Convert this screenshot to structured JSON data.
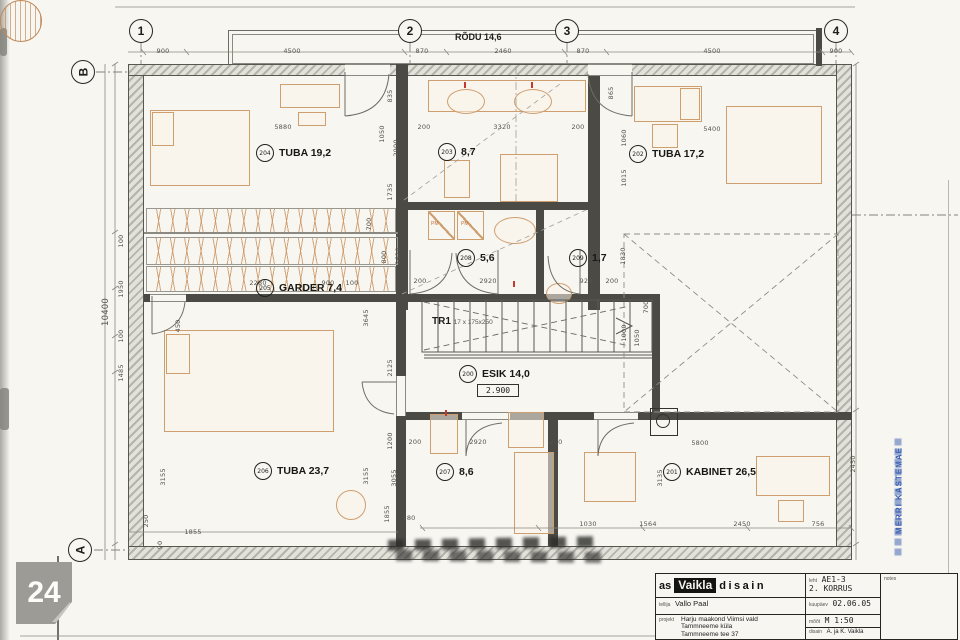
{
  "drawing": {
    "floor_title": "2. KORRUS",
    "balcony_label": "RÕDU 14,6",
    "stair": {
      "label": "TR1",
      "spec": "17 x 175x250"
    },
    "esik_level": "2.900",
    "appliance_label": "PM"
  },
  "axes": {
    "top": [
      {
        "label": "1",
        "x": 141
      },
      {
        "label": "2",
        "x": 410
      },
      {
        "label": "3",
        "x": 567
      },
      {
        "label": "4",
        "x": 836
      }
    ],
    "left": [
      {
        "label": "B",
        "x": 83,
        "y": 72
      },
      {
        "label": "A",
        "x": 80,
        "y": 550
      }
    ]
  },
  "rooms": [
    {
      "num": "204",
      "name": "TUBA 19,2",
      "x": 256,
      "y": 144
    },
    {
      "num": "203",
      "name": "8,7",
      "x": 438,
      "y": 143
    },
    {
      "num": "202",
      "name": "TUBA 17,2",
      "x": 629,
      "y": 145
    },
    {
      "num": "205",
      "name": "GARDER 7,4",
      "x": 256,
      "y": 279
    },
    {
      "num": "208",
      "name": "5,6",
      "x": 457,
      "y": 249
    },
    {
      "num": "209",
      "name": "1,7",
      "x": 569,
      "y": 249
    },
    {
      "num": "200",
      "name": "ESIK 14,0",
      "x": 459,
      "y": 365
    },
    {
      "num": "206",
      "name": "TUBA 23,7",
      "x": 254,
      "y": 462
    },
    {
      "num": "207",
      "name": "8,6",
      "x": 436,
      "y": 463
    },
    {
      "num": "201",
      "name": "KABINET 26,5",
      "x": 663,
      "y": 463
    }
  ],
  "dims": [
    {
      "t": "900",
      "x": 163,
      "y": 51
    },
    {
      "t": "4500",
      "x": 292,
      "y": 51
    },
    {
      "t": "870",
      "x": 422,
      "y": 51
    },
    {
      "t": "2460",
      "x": 503,
      "y": 51
    },
    {
      "t": "870",
      "x": 583,
      "y": 51
    },
    {
      "t": "4500",
      "x": 712,
      "y": 51
    },
    {
      "t": "900",
      "x": 836,
      "y": 51
    },
    {
      "t": "5880",
      "x": 283,
      "y": 127
    },
    {
      "t": "200",
      "x": 424,
      "y": 127
    },
    {
      "t": "3320",
      "x": 502,
      "y": 127
    },
    {
      "t": "200",
      "x": 578,
      "y": 127
    },
    {
      "t": "5400",
      "x": 712,
      "y": 129
    },
    {
      "t": "835",
      "x": 390,
      "y": 96,
      "v": 1
    },
    {
      "t": "865",
      "x": 611,
      "y": 93,
      "v": 1
    },
    {
      "t": "1050",
      "x": 382,
      "y": 134,
      "v": 1
    },
    {
      "t": "2900",
      "x": 396,
      "y": 148,
      "v": 1
    },
    {
      "t": "1060",
      "x": 624,
      "y": 138,
      "v": 1
    },
    {
      "t": "1015",
      "x": 624,
      "y": 178,
      "v": 1
    },
    {
      "t": "10400",
      "x": 106,
      "y": 312,
      "v": 1,
      "b": 1
    },
    {
      "t": "100",
      "x": 121,
      "y": 241,
      "v": 1
    },
    {
      "t": "1950",
      "x": 121,
      "y": 289,
      "v": 1
    },
    {
      "t": "100",
      "x": 121,
      "y": 336,
      "v": 1
    },
    {
      "t": "1485",
      "x": 121,
      "y": 373,
      "v": 1
    },
    {
      "t": "450",
      "x": 178,
      "y": 326,
      "v": 1
    },
    {
      "t": "1735",
      "x": 390,
      "y": 192,
      "v": 1
    },
    {
      "t": "1620",
      "x": 398,
      "y": 256,
      "v": 1
    },
    {
      "t": "3645",
      "x": 366,
      "y": 318,
      "v": 1
    },
    {
      "t": "2125",
      "x": 390,
      "y": 368,
      "v": 1
    },
    {
      "t": "1200",
      "x": 390,
      "y": 441,
      "v": 1
    },
    {
      "t": "3155",
      "x": 366,
      "y": 476,
      "v": 1
    },
    {
      "t": "3055",
      "x": 394,
      "y": 478,
      "v": 1
    },
    {
      "t": "1855",
      "x": 387,
      "y": 514,
      "v": 1
    },
    {
      "t": "180",
      "x": 409,
      "y": 518
    },
    {
      "t": "2280",
      "x": 258,
      "y": 283
    },
    {
      "t": "900",
      "x": 328,
      "y": 283
    },
    {
      "t": "100",
      "x": 352,
      "y": 283
    },
    {
      "t": "700",
      "x": 369,
      "y": 224,
      "v": 1
    },
    {
      "t": "800",
      "x": 384,
      "y": 257,
      "v": 1
    },
    {
      "t": "1830",
      "x": 623,
      "y": 256,
      "v": 1
    },
    {
      "t": "200",
      "x": 420,
      "y": 281
    },
    {
      "t": "2920",
      "x": 488,
      "y": 281
    },
    {
      "t": "920",
      "x": 586,
      "y": 281
    },
    {
      "t": "200",
      "x": 612,
      "y": 281
    },
    {
      "t": "700",
      "x": 646,
      "y": 307,
      "v": 1
    },
    {
      "t": "1000",
      "x": 624,
      "y": 333,
      "v": 1
    },
    {
      "t": "1050",
      "x": 637,
      "y": 338,
      "v": 1
    },
    {
      "t": "200",
      "x": 415,
      "y": 442
    },
    {
      "t": "2920",
      "x": 478,
      "y": 442
    },
    {
      "t": "200",
      "x": 556,
      "y": 442
    },
    {
      "t": "5800",
      "x": 700,
      "y": 443
    },
    {
      "t": "1030",
      "x": 588,
      "y": 524
    },
    {
      "t": "1564",
      "x": 648,
      "y": 524
    },
    {
      "t": "2450",
      "x": 742,
      "y": 524
    },
    {
      "t": "756",
      "x": 818,
      "y": 524
    },
    {
      "t": "2450",
      "x": 853,
      "y": 464,
      "v": 1
    },
    {
      "t": "3135",
      "x": 660,
      "y": 478,
      "v": 1
    },
    {
      "t": "250",
      "x": 146,
      "y": 521,
      "v": 1
    },
    {
      "t": "90",
      "x": 160,
      "y": 545,
      "v": 1
    },
    {
      "t": "1855",
      "x": 193,
      "y": 532
    },
    {
      "t": "3155",
      "x": 163,
      "y": 477,
      "v": 1
    }
  ],
  "stamp": {
    "text": "MERRI KASTEMAE"
  },
  "badge": {
    "number": "24"
  },
  "title_block": {
    "brand_prefix": "as",
    "brand_name": "Vaikla",
    "brand_suffix": "disain",
    "sheet_label": "leht",
    "sheet_value": "AE1-3",
    "sheet_value2": "2. KORRUS",
    "notes_label": "notes",
    "client_label": "tellija",
    "client_value": "Vallo Paal",
    "date_label": "kuupäev",
    "date_value": "02.06.05",
    "project_label": "projekt",
    "project_lines": [
      "Harju maakond Viimsi vald",
      "Tammneeme küla",
      "Tammneeme tee 37"
    ],
    "scale_label": "mõõt",
    "scale_value": "M 1:50",
    "design_label": "disain",
    "design_value": "A. ja K. Vaikla"
  }
}
